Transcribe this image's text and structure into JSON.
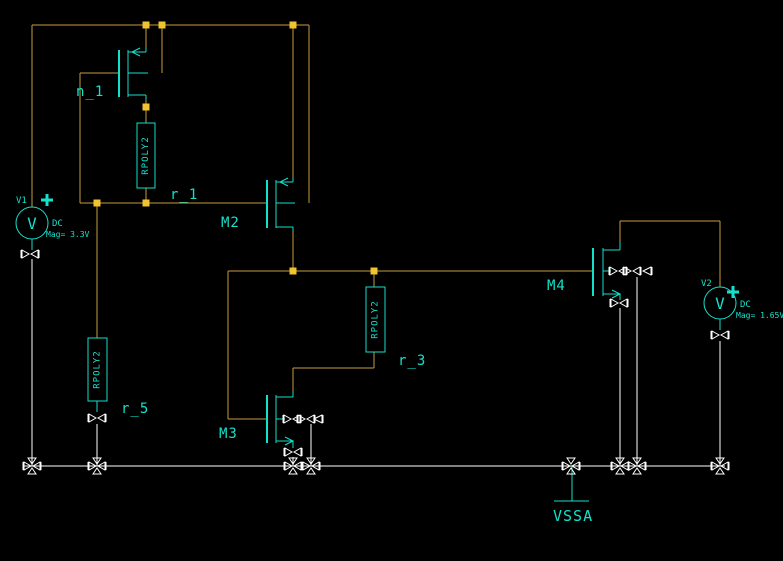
{
  "app": {
    "type": "schematic-editor-canvas"
  },
  "colors": {
    "background": "#000000",
    "wire": "#C89B40",
    "junction": "#EFC42F",
    "device": "#14E1CB",
    "ground_net": "#FFFFFF"
  },
  "icons": {
    "pin": "bowtie-pin",
    "junction": "solder-square",
    "plus": "polarity-plus",
    "ground": "ground-rail"
  },
  "transistors": [
    {
      "label": "n_1",
      "type": "pmos"
    },
    {
      "label": "M2",
      "type": "pmos"
    },
    {
      "label": "M3",
      "type": "nmos"
    },
    {
      "label": "M4",
      "type": "nmos"
    }
  ],
  "resistors": [
    {
      "label": "r_1",
      "model": "RPOLY2"
    },
    {
      "label": "r_3",
      "model": "RPOLY2"
    },
    {
      "label": "r_5",
      "model": "RPOLY2"
    }
  ],
  "sources": [
    {
      "designator": "V1",
      "body_letter": "V",
      "line1": "DC",
      "line2": "Mag= 3.3V"
    },
    {
      "designator": "V2",
      "body_letter": "V",
      "line1": "DC",
      "line2": "Mag= 1.65V"
    }
  ],
  "ground": {
    "label": "VSSA"
  }
}
